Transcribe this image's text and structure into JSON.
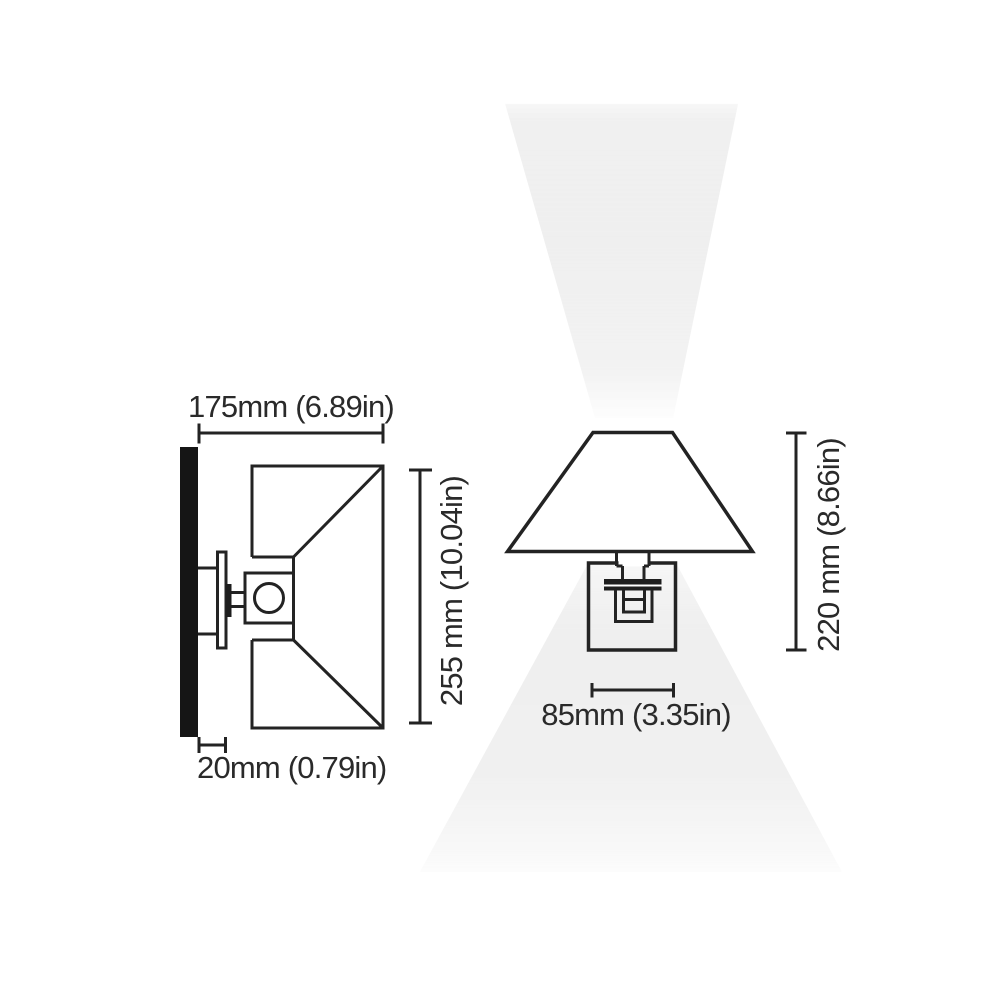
{
  "colors": {
    "bg": "#ffffff",
    "line": "#232323",
    "text": "#2a2a2a",
    "wall": "#151515",
    "metal": "#1e1e1e",
    "glow": "#ececec"
  },
  "diagram": {
    "side_view": {
      "projection": "175mm (6.89in)",
      "shade_width": "255 mm (10.04in)",
      "backplate_depth": "20mm (0.79in)"
    },
    "front_view": {
      "overall_height": "220 mm (8.66in)",
      "backplate_width": "85mm (3.35in)"
    }
  }
}
